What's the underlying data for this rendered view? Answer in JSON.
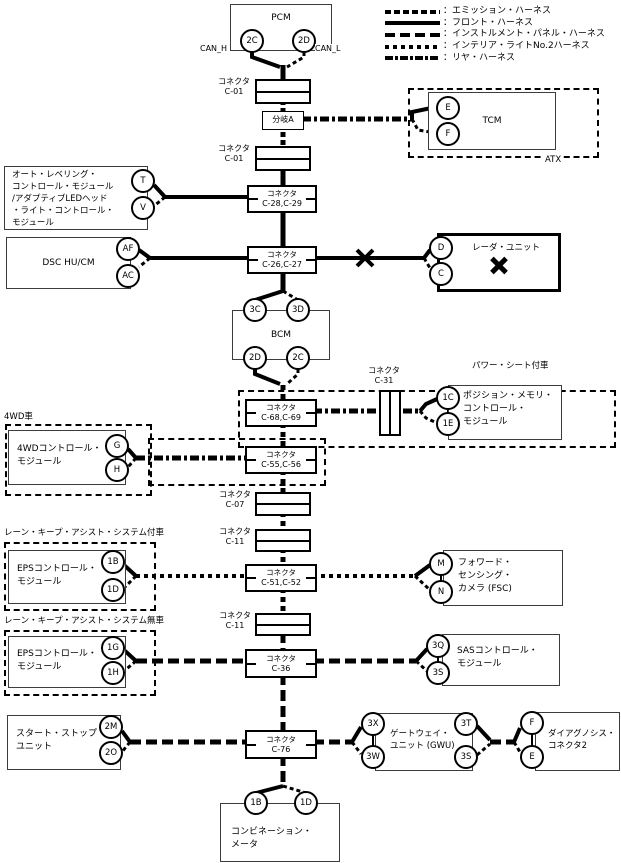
{
  "labels": {
    "connector": "コネクタ",
    "branch_a": "分岐A",
    "can_h": "CAN_H",
    "can_l": "CAN_L",
    "atx": "ATX"
  },
  "legend": {
    "items": [
      {
        "name": "emission",
        "label": "：エミッション・ハーネス"
      },
      {
        "name": "front",
        "label": "：フロント・ハーネス"
      },
      {
        "name": "instrument-panel",
        "label": "：インストルメント・パネル・ハーネス"
      },
      {
        "name": "interior-light-no2",
        "label": "：インテリア・ライトNo.2ハーネス"
      },
      {
        "name": "rear",
        "label": "：リヤ・ハーネス"
      }
    ]
  },
  "regions": {
    "power_seat": "パワー・シート付車",
    "awd": "4WD車",
    "lka_with": "レーン・キープ・アシスト・システム付車",
    "lka_without": "レーン・キープ・アシスト・システム無車"
  },
  "modules": {
    "pcm": "PCM",
    "tcm": "TCM",
    "auto_leveling": "オート・レベリング・\nコントロール・モジュール\n/アダプティブLEDヘッド\n・ライト・コントロール・\nモジュール",
    "dsc": "DSC HU/CM",
    "radar": "レーダ・ユニット",
    "bcm": "BCM",
    "position_memory": "ポジション・メモリ・\nコントロール・\nモジュール",
    "awd_module": "4WDコントロール・\nモジュール",
    "eps_with": "EPSコントロール・\nモジュール",
    "fsc": "フォワード・\nセンシング・\nカメラ (FSC)",
    "eps_without": "EPSコントロール・\nモジュール",
    "sas": "SASコントロール・\nモジュール",
    "start_stop": "スタート・ストップ・\nユニット",
    "gwu": "ゲートウェイ・\nユニット (GWU)",
    "diag2": "ダイアグノシス・\nコネクタ2",
    "combination_meter": "コンビネーション・\nメータ"
  },
  "connectors": {
    "c01a": "C-01",
    "c01b": "C-01",
    "c2829": "C-28,C-29",
    "c2627": "C-26,C-27",
    "c6869": "C-68,C-69",
    "c31": "C-31",
    "c5556": "C-55,C-56",
    "c07": "C-07",
    "c11a": "C-11",
    "c5152": "C-51,C-52",
    "c11b": "C-11",
    "c36": "C-36",
    "c76": "C-76"
  },
  "pins": {
    "pcm_2c": "2C",
    "pcm_2d": "2D",
    "tcm_e": "E",
    "tcm_f": "F",
    "alm_t": "T",
    "alm_v": "V",
    "dsc_af": "AF",
    "dsc_ac": "AC",
    "radar_d": "D",
    "radar_c": "C",
    "bcm_3c": "3C",
    "bcm_3d": "3D",
    "bcm_2d": "2D",
    "bcm_2c": "2C",
    "pmc_1c": "1C",
    "pmc_1e": "1E",
    "awd_g": "G",
    "awd_h": "H",
    "eps1_1b": "1B",
    "eps1_1d": "1D",
    "fsc_m": "M",
    "fsc_n": "N",
    "eps2_1g": "1G",
    "eps2_1h": "1H",
    "sas_3q": "3Q",
    "sas_3s": "3S",
    "ssu_2m": "2M",
    "ssu_2o": "2O",
    "gwu_3x": "3X",
    "gwu_3w": "3W",
    "gwu_3t": "3T",
    "gwu_3s": "3S",
    "diag_f": "F",
    "diag_e": "E",
    "cm_1b": "1B",
    "cm_1d": "1D"
  }
}
